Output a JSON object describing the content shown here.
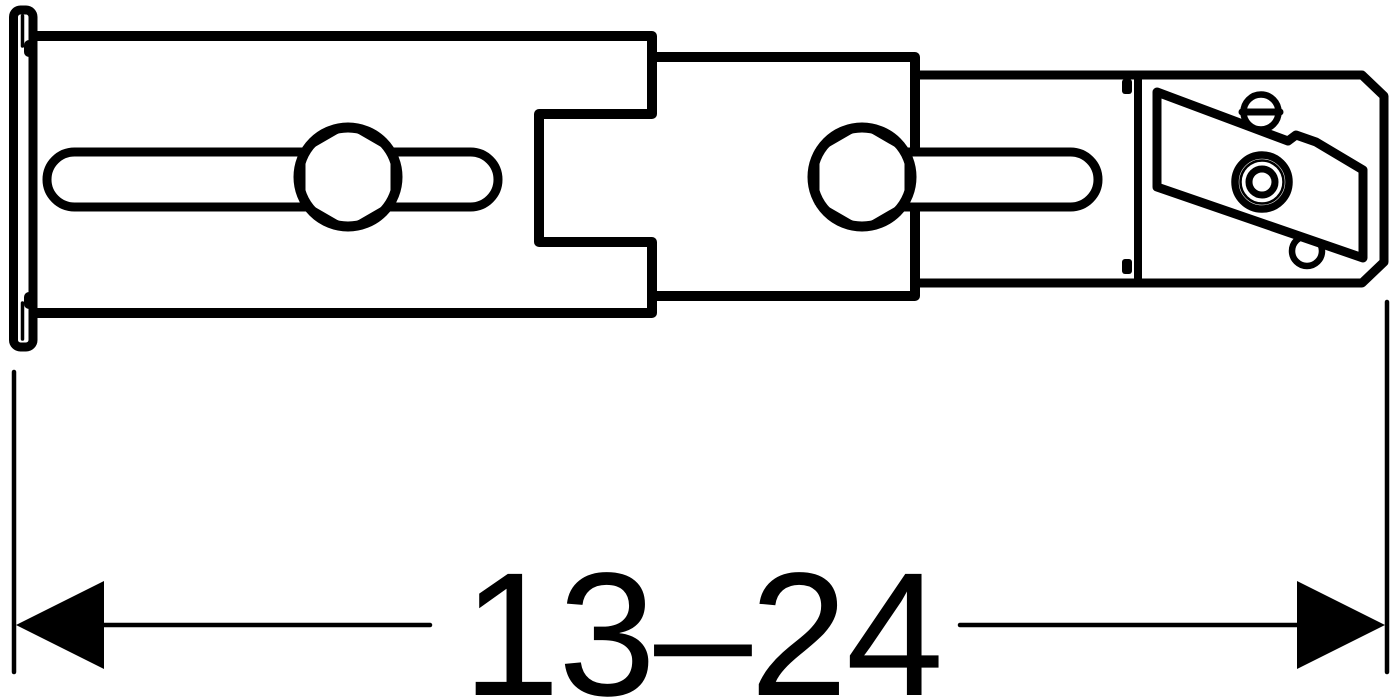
{
  "diagram": {
    "type": "technical-line-drawing",
    "subject": "adjustable telescoping wall-mount bracket, side view",
    "background_color": "#ffffff",
    "line_color": "#000000",
    "dimension": {
      "label": "13–24",
      "orientation": "horizontal",
      "arrows": "outward-pointing filled triangles at both extension lines"
    },
    "parts": [
      "mounting-flange",
      "outer-rail",
      "adjustment-slot-left",
      "hex-bolt-left",
      "middle-slider",
      "adjustment-slot-right",
      "hex-bolt-right",
      "end-bracket",
      "angled-clamp-plate",
      "slotted-screw-head",
      "bushing",
      "pivot-pin"
    ]
  }
}
